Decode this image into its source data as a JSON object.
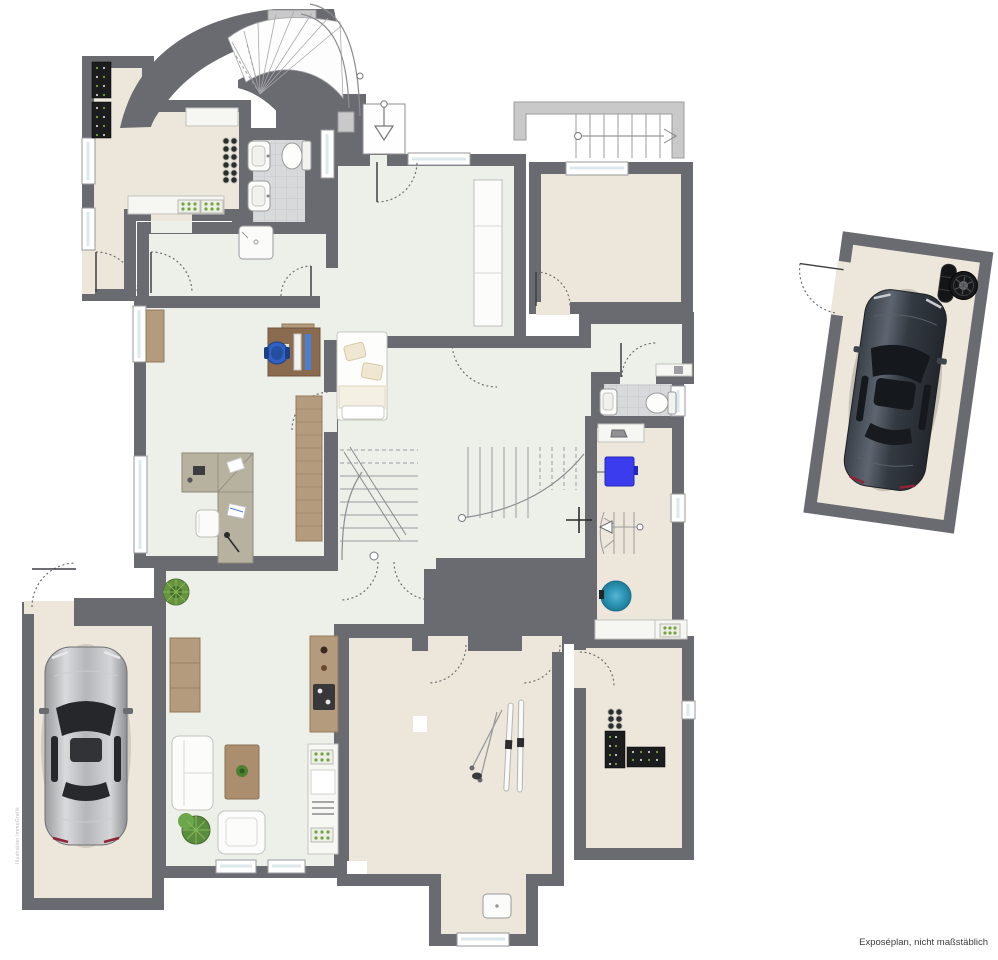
{
  "caption": {
    "text": "Exposéplan, nicht maßstäblich"
  },
  "watermark": {
    "text": "Illustration ImmoGrafik"
  },
  "palette": {
    "wall": "#6a6a71",
    "floor_beige": "#ece7da",
    "floor_light": "#edefe9",
    "tile": "#d8d9da",
    "tile_line": "#c7c8c9",
    "glass": "#dce8ee",
    "wood": "#b59b7e",
    "wood_dark": "#8a6b4f",
    "counter": "#f6f6f3",
    "appliance_blue": "#3a3cee",
    "boiler_teal": "#2b93b4",
    "plant_green": "#5a8c3e",
    "car_silver": "#b9babd",
    "car_dark": "#3d444c",
    "stair_line": "#9b9b9f",
    "railing": "#c9c9ca",
    "door_arc": "#6f6f73"
  }
}
